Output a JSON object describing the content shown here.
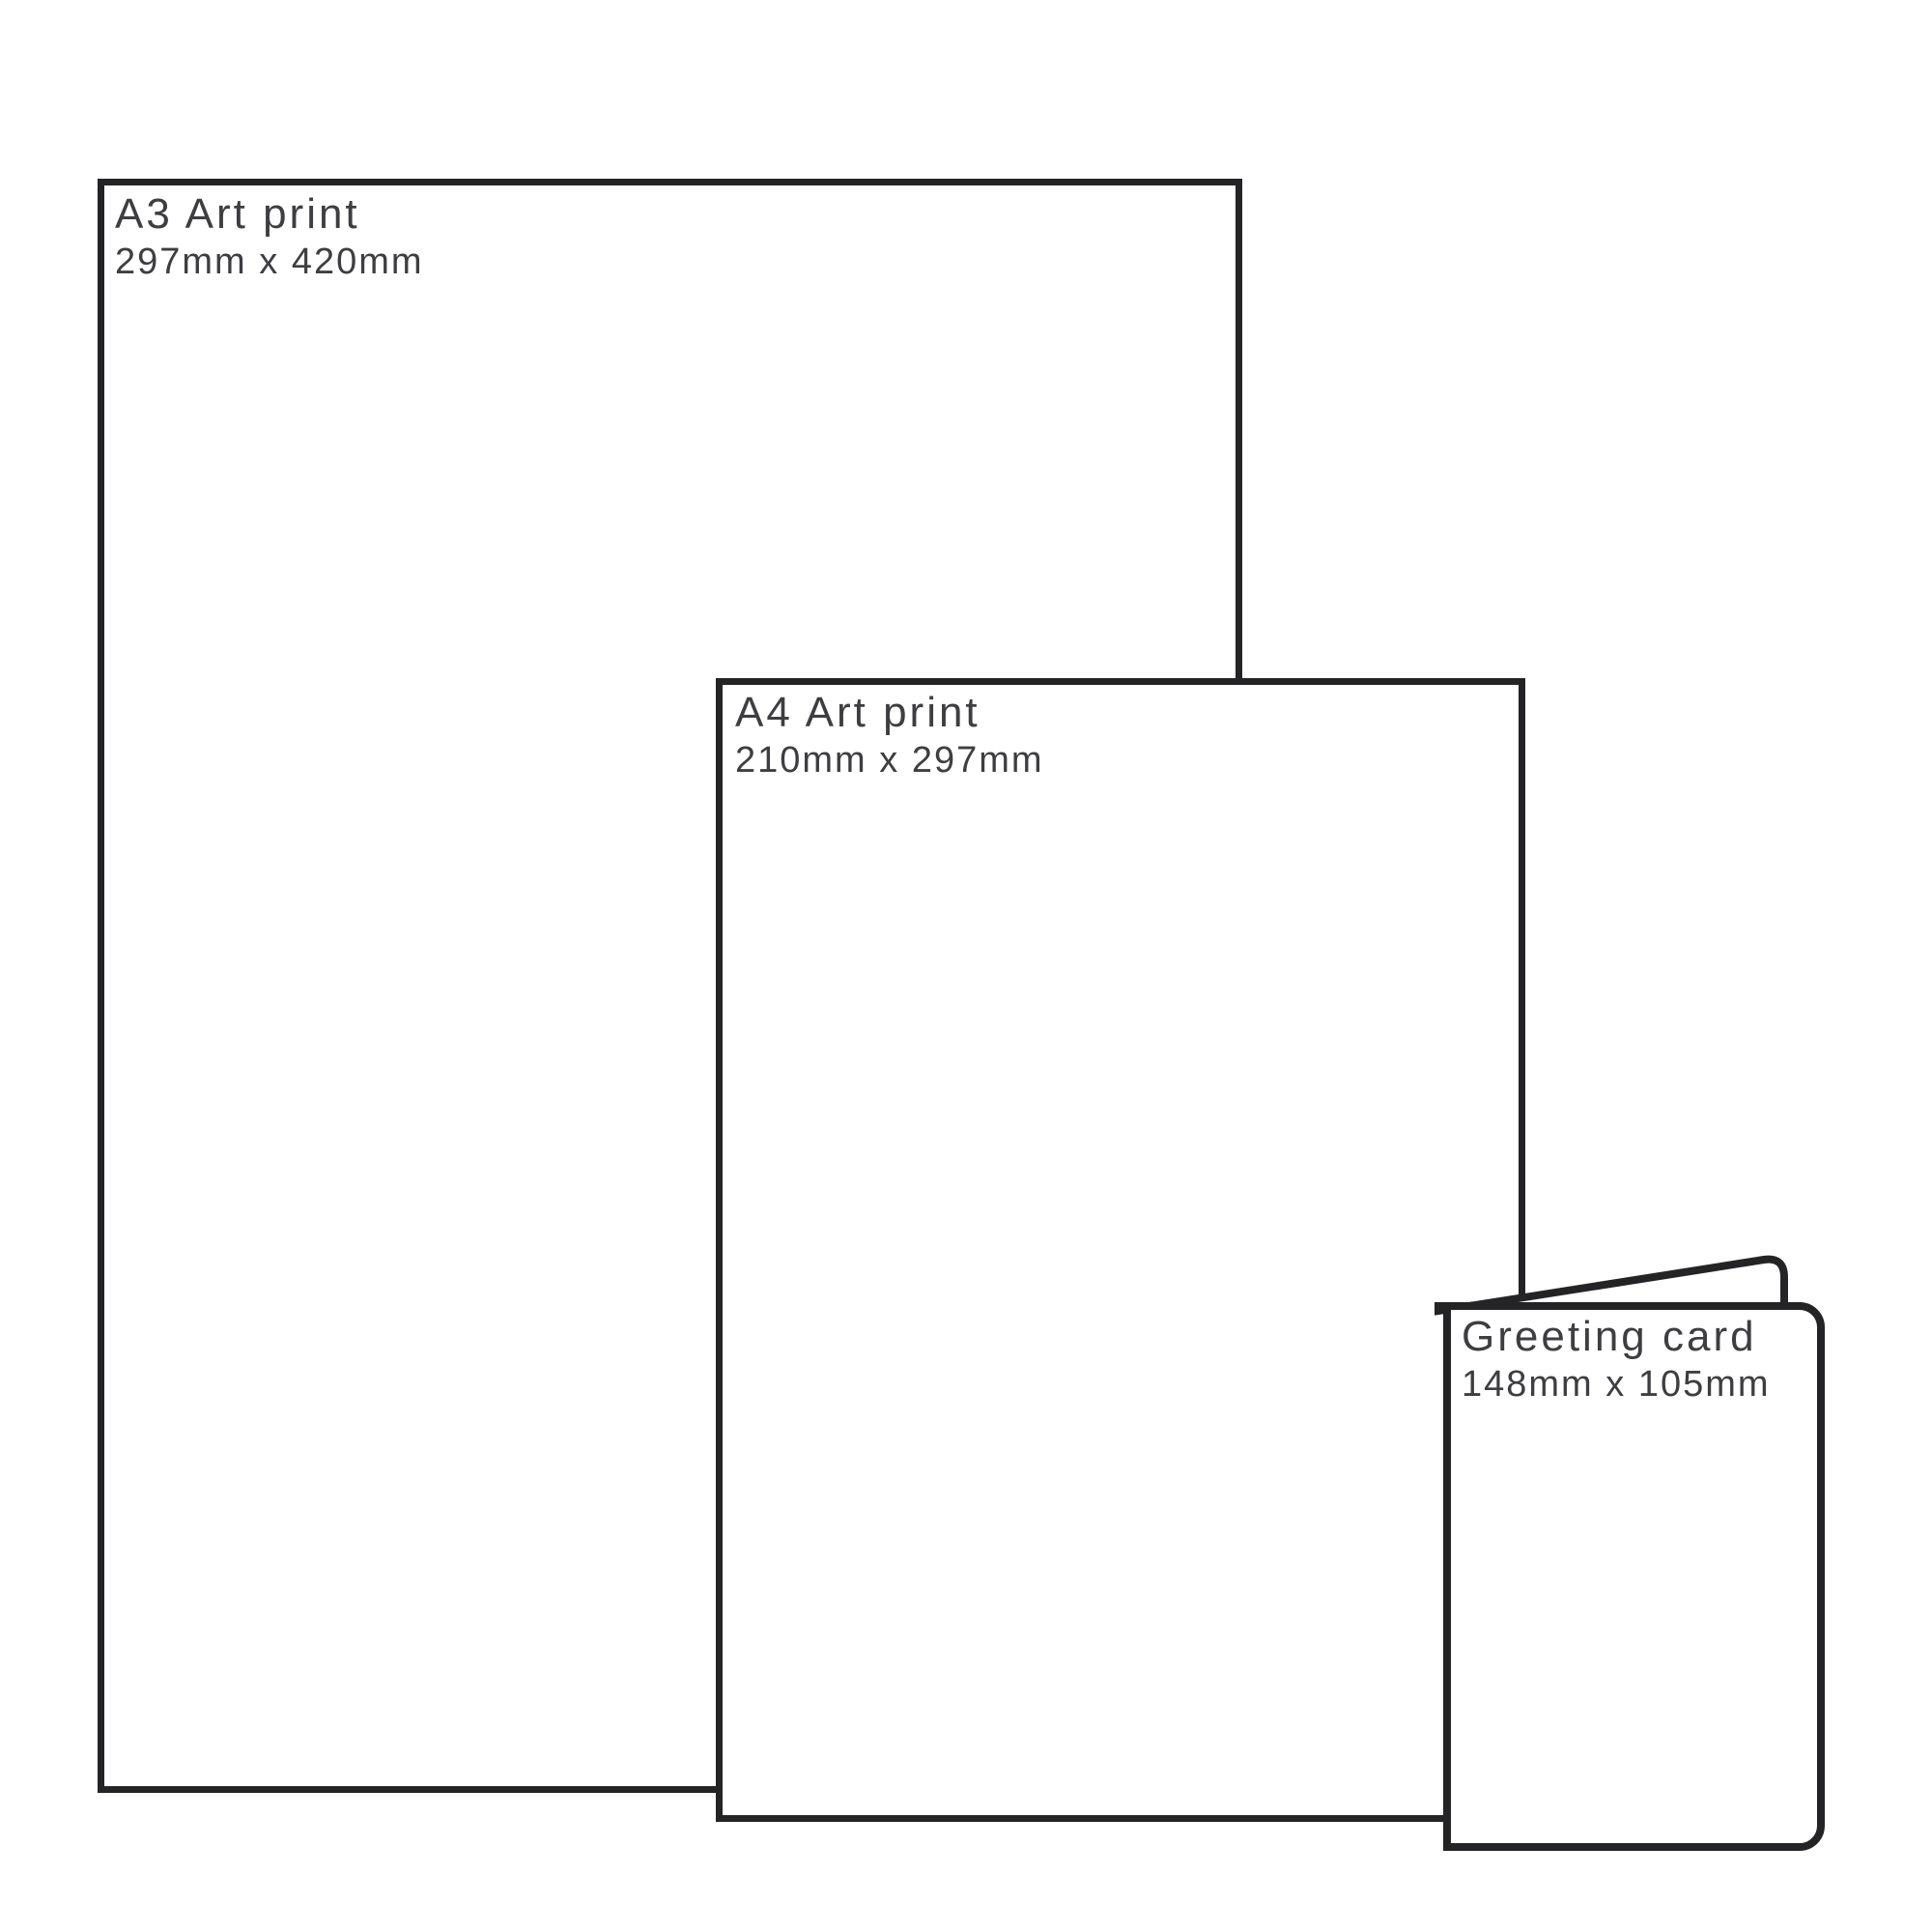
{
  "diagram": {
    "kind": "print-size-comparison",
    "background": "#ffffff"
  },
  "colors": {
    "outline": "#242427",
    "label": "#3e3e42",
    "paper": "#ffffff"
  },
  "items": [
    {
      "id": "a3-print",
      "label": "A3 Art print",
      "dimensions": "297mm x 420mm"
    },
    {
      "id": "a4-print",
      "label": "A4 Art print",
      "dimensions": "210mm x 297mm"
    },
    {
      "id": "greeting-card",
      "label": "Greeting card",
      "dimensions": "148mm x 105mm"
    }
  ]
}
